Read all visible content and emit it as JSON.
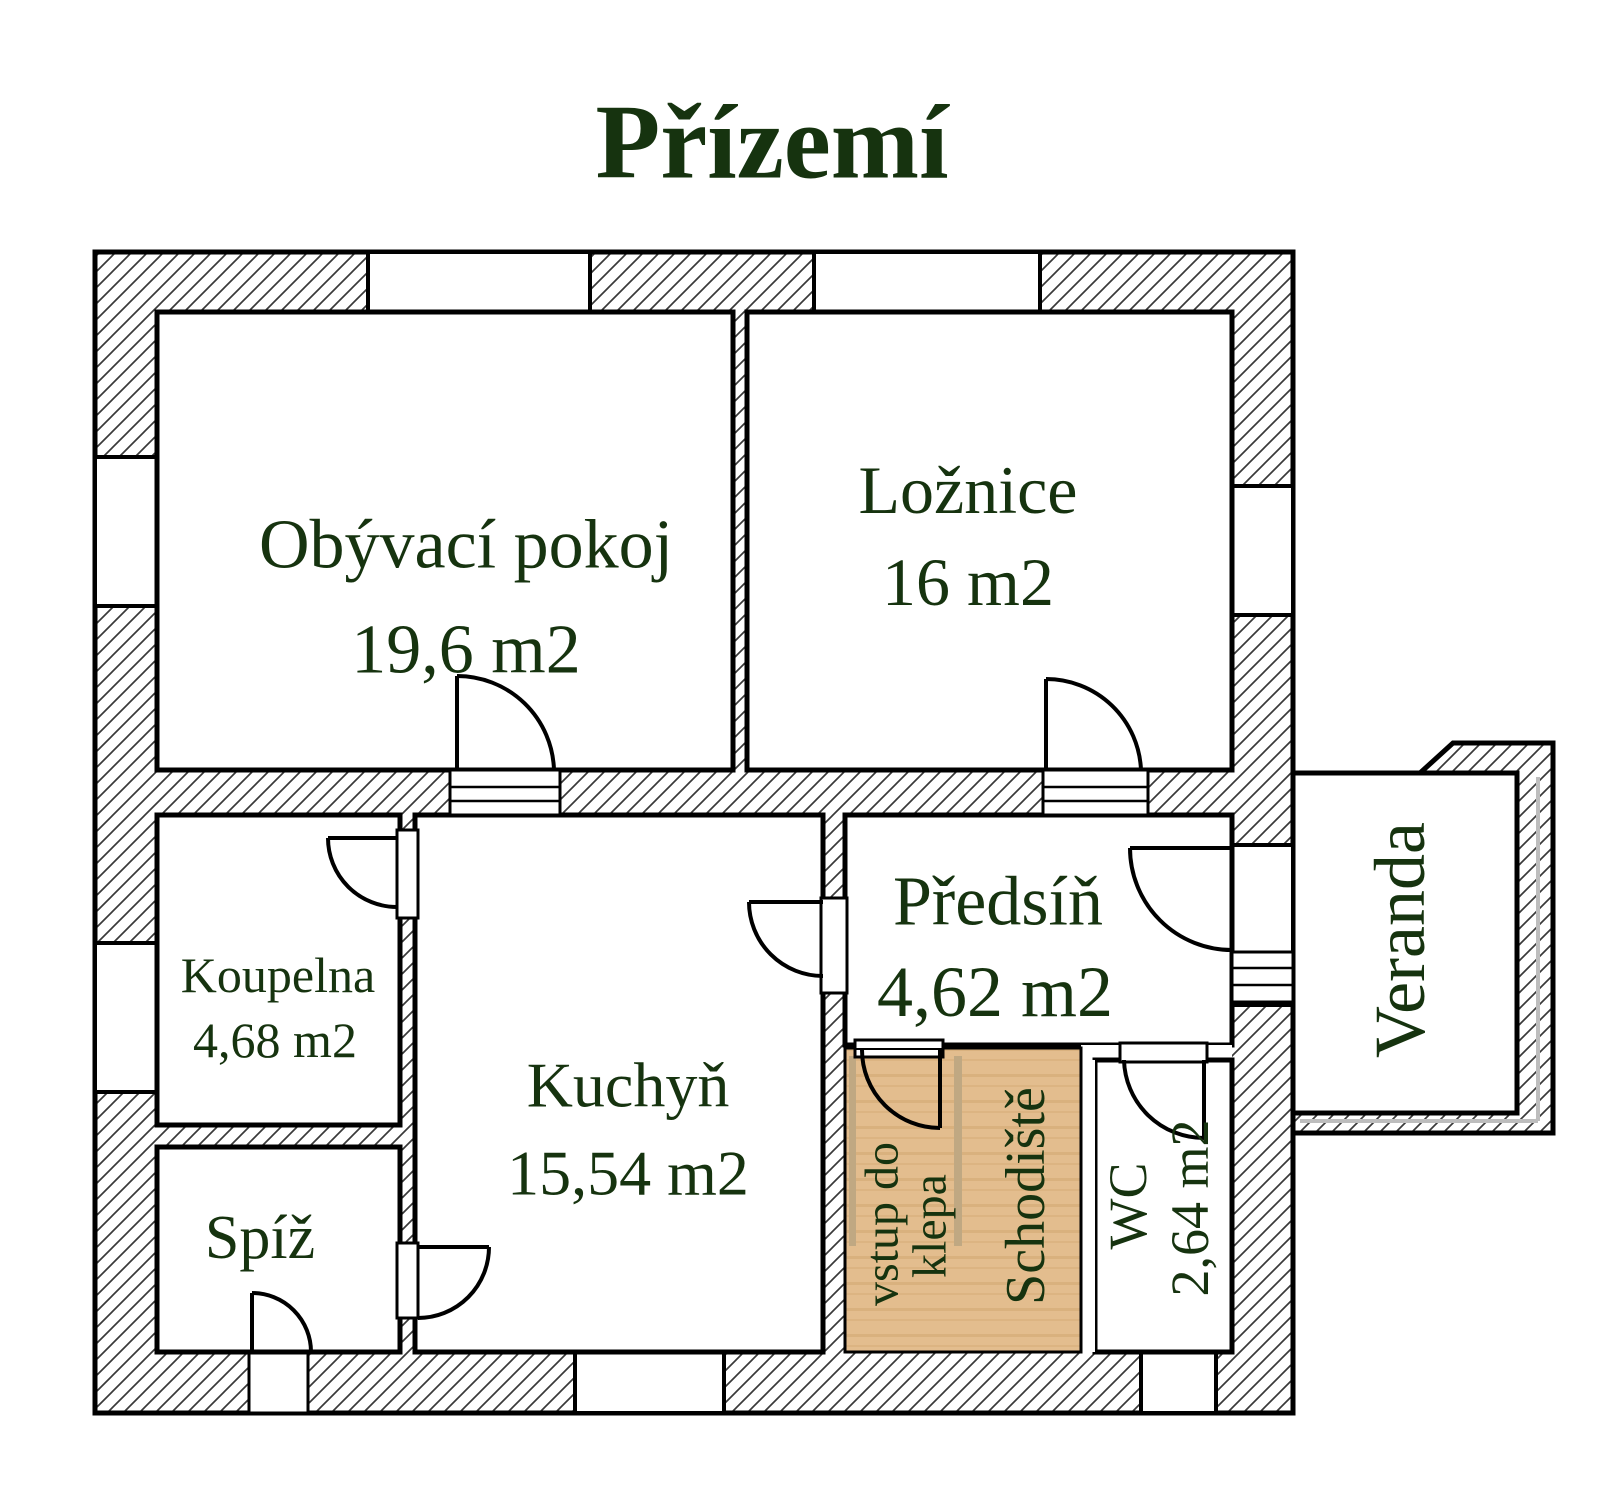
{
  "title": "Přízemí",
  "colors": {
    "text": "#16330f",
    "wall_line": "#000000",
    "hatch_line": "#3a3a3a",
    "stair_fill": "#e3bd8e",
    "stair_stripe": "#d9b17e",
    "stair_rail": "#c0a882",
    "veranda_accent": "#bdbdbd"
  },
  "rooms": {
    "obyvaci_pokoj": {
      "name": "Obývací pokoj",
      "area": "19,6 m2"
    },
    "loznice": {
      "name": "Ložnice",
      "area": "16 m2"
    },
    "koupelna": {
      "name": "Koupelna",
      "area": "4,68 m2"
    },
    "spiz": {
      "name": "Spíž"
    },
    "kuchyn": {
      "name": "Kuchyň",
      "area": "15,54 m2"
    },
    "predsin": {
      "name": "Předsíň",
      "area": "4,62 m2"
    },
    "wc": {
      "name": "WC",
      "area": "2,64 m2"
    },
    "veranda": {
      "name": "Veranda"
    },
    "schodiste": {
      "name": "Schodiště"
    },
    "cellar_entrance": {
      "line1": "vstup do",
      "line2": "klepa"
    }
  }
}
